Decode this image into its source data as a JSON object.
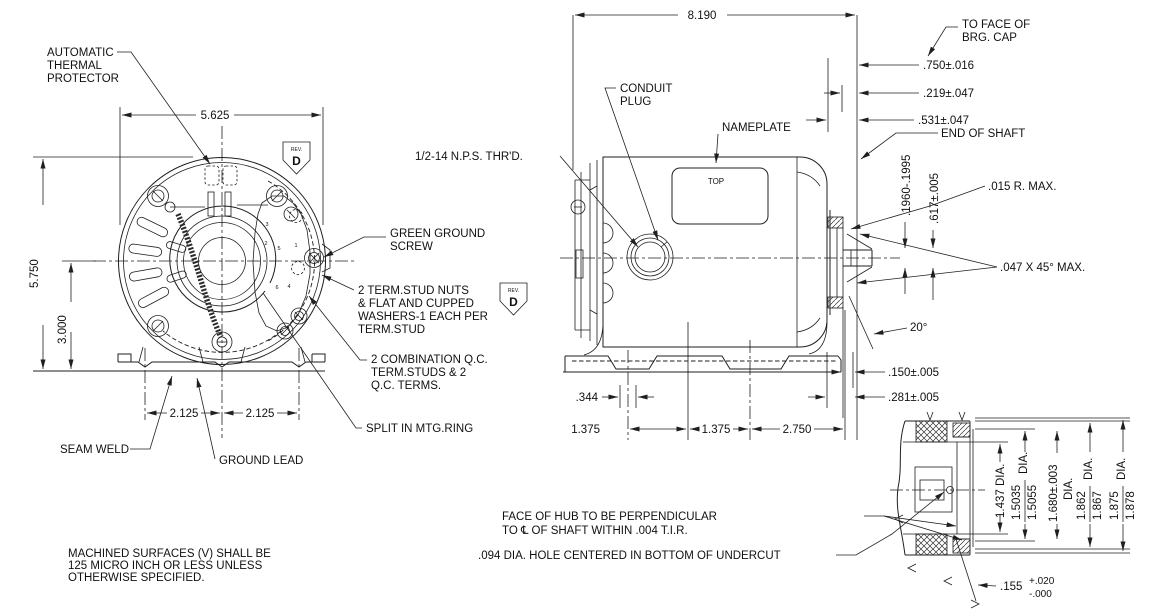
{
  "colors": {
    "background": "#ffffff",
    "line": "#1f1f1f",
    "text": "#111111"
  },
  "rev": {
    "label": "REV.",
    "letter": "D"
  },
  "front": {
    "labels": {
      "atp": [
        "AUTOMATIC",
        "THERMAL",
        "PROTECTOR"
      ],
      "seam_weld": "SEAM WELD",
      "ground_lead": "GROUND LEAD",
      "green_ground_screw": [
        "GREEN GROUND",
        "SCREW"
      ],
      "term_stud_nuts": [
        "2 TERM.STUD NUTS",
        "& FLAT AND CUPPED",
        "WASHERS-1 EACH PER",
        "TERM.STUD"
      ],
      "combination_qc": [
        "2 COMBINATION Q.C.",
        "TERM.STUDS & 2",
        "Q.C. TERMS."
      ],
      "split_mtg_ring": "SPLIT IN MTG.RING"
    },
    "dims": {
      "width": "5.625",
      "height": "5.750",
      "center_height": "3.000",
      "foot_left": "2.125",
      "foot_right": "2.125"
    },
    "terminal_numbers": [
      "3",
      "2",
      "5",
      "1",
      "6",
      "4"
    ]
  },
  "side": {
    "labels": {
      "conduit_plug": [
        "CONDUIT",
        "PLUG"
      ],
      "nps_thread": "1/2-14 N.P.S. THR'D.",
      "nameplate": "NAMEPLATE",
      "top": "TOP",
      "to_face": [
        "TO FACE OF",
        "BRG. CAP"
      ],
      "end_of_shaft": "END OF SHAFT",
      "radius_max": ".015 R. MAX.",
      "chamfer": ".047 X 45° MAX.",
      "angle": "20°"
    },
    "dims": {
      "overall": "8.190",
      "d750": ".750±.016",
      "d219": ".219±.047",
      "d531": ".531±.047",
      "flat": ".1960-.1995",
      "d617": ".617±.005",
      "d150": ".150±.005",
      "d281": ".281±.005",
      "d344": ".344",
      "f1": "1.375",
      "f2": "1.375",
      "f3": "2.750"
    }
  },
  "detail": {
    "labels": {
      "face_of_hub": [
        "FACE OF HUB TO BE PERPENDICULAR",
        "TO ℄ OF SHAFT WITHIN .004 T.I.R."
      ],
      "hole": ".094 DIA. HOLE CENTERED IN BOTTOM OF UNDERCUT"
    },
    "dims": {
      "bore": "1.437 DIA.",
      "d1n": "1.5035",
      "d1d": "1.5055",
      "d1s": "DIA.",
      "d2": "1.680±.003",
      "d2s": "DIA.",
      "d3n": "1.862",
      "d3d": "1.867",
      "d3s": "DIA.",
      "d4n": "1.875",
      "d4d": "1.878",
      "d4s": "DIA.",
      "u": ".155",
      "up": "+.020",
      "um": "-.000"
    }
  },
  "note": [
    "MACHINED SURFACES (V) SHALL BE",
    "125 MICRO INCH OR LESS UNLESS",
    "OTHERWISE SPECIFIED."
  ]
}
